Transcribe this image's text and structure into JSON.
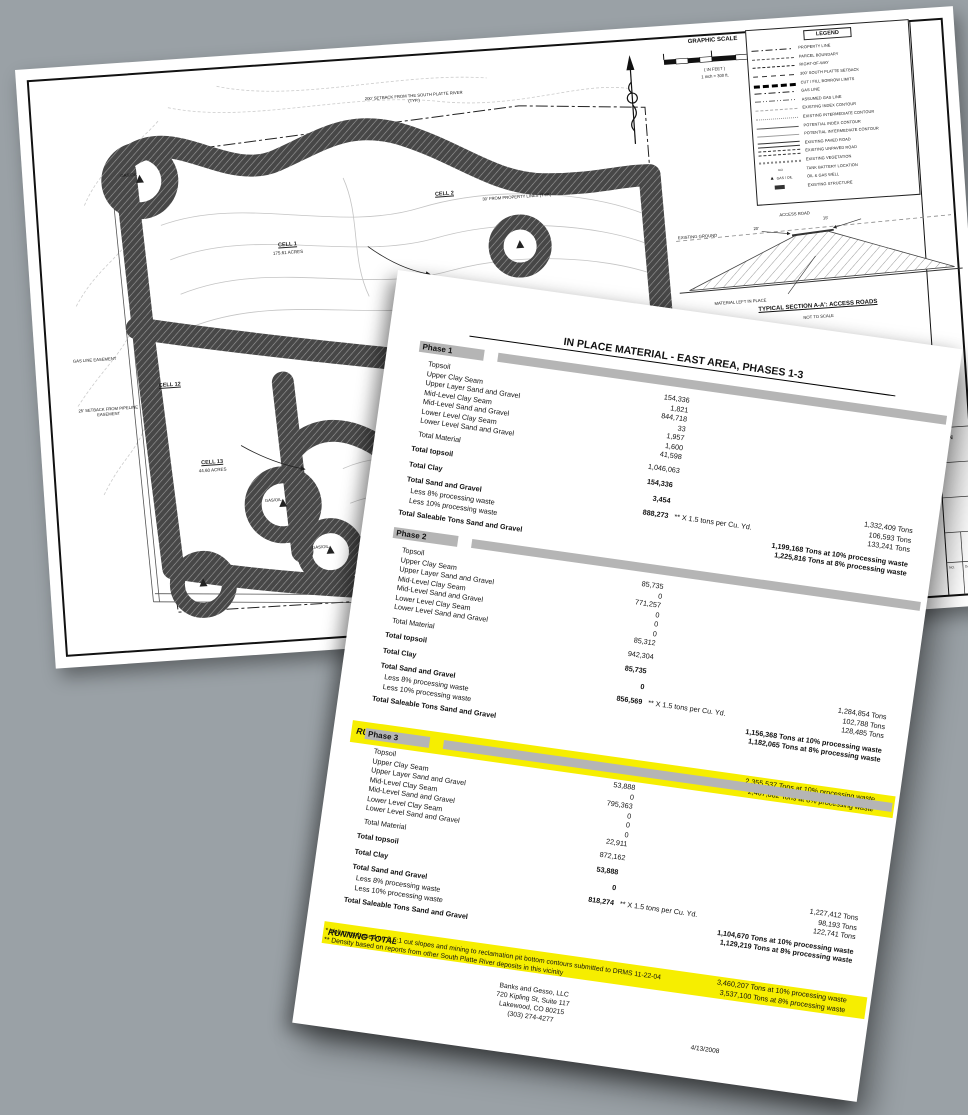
{
  "page": {
    "background": "#9aa1a6"
  },
  "colors": {
    "highlight_yellow": "#f6ee00",
    "band_gray": "#b5b5b5"
  },
  "map_sheet": {
    "graphic_scale": {
      "title": "GRAPHIC SCALE",
      "in_feet": "( IN FEET )",
      "scale_note": "1 inch = 300 ft."
    },
    "legend": {
      "title": "LEGEND",
      "well_symbol_label": "GAS / OIL",
      "items": [
        "PROPERTY LINE",
        "PARCEL BOUNDARY",
        "RIGHT-OF-WAY",
        "300' SOUTH PLATTE SETBACK",
        "CUT / FILL BORROW LIMITS",
        "GAS LINE",
        "ASSUMED GAS LINE",
        "EXISTING INDEX CONTOUR",
        "EXISTING INTERMEDIATE CONTOUR",
        "POTENTIAL INDEX CONTOUR",
        "POTENTIAL INTERMEDIATE CONTOUR",
        "EXISTING PAVED ROAD",
        "EXISTING UNPAVED ROAD",
        "EXISTING VEGETATION",
        "TANK BATTERY LOCATION",
        "OIL & GAS WELL",
        "EXISTING STRUCTURE"
      ]
    },
    "cells": [
      {
        "name": "CELL 1",
        "acres": "175.61 ACRES"
      },
      {
        "name": "CELL 2",
        "acres": ""
      },
      {
        "name": "CELL 11",
        "acres": "93.90 ACRES"
      },
      {
        "name": "CELL 12",
        "acres": ""
      },
      {
        "name": "CELL 13",
        "acres": "44.60 ACRES"
      }
    ],
    "annotations": {
      "river_setback": "200' SETBACK FROM THE SOUTH PLATTE RIVER (TYP.)",
      "property_setback": "30' FROM PROPERTY LINES (TYP.)",
      "gas_line_easement": "GAS LINE EASEMENT",
      "pipeline_setback": "25' SETBACK FROM PIPELINE EASEMENT",
      "well_label": "GAS/OIL"
    },
    "section": {
      "title": "TYPICAL SECTION A-A': ACCESS ROADS",
      "subtitle": "NOT TO SCALE",
      "existing_ground": "EXISTING GROUND",
      "access_road": "ACCESS ROAD",
      "material_note": "MATERIAL LEFT IN PLACE",
      "dim_left": "20'",
      "dim_right": "15'"
    },
    "title_block": {
      "fragment": "AN",
      "rev_label": "NO.",
      "date_label": "DATE"
    }
  },
  "report": {
    "title": "IN PLACE MATERIAL - EAST AREA, PHASES 1-3",
    "seam_labels": [
      "Topsoil",
      "Upper Clay Seam",
      "Upper Layer Sand and Gravel",
      "Mid-Level Clay Seam",
      "Mid-Level Sand and Gravel",
      "Lower Level Clay Seam",
      "Lower Level Sand and Gravel"
    ],
    "labels": {
      "total_material": "Total Material",
      "total_topsoil": "Total topsoil",
      "total_clay": "Total Clay",
      "total_sand": "Total Sand and Gravel",
      "less8": "Less 8% processing waste",
      "less10": "Less 10% processing waste",
      "saleable": "Total Saleable Tons Sand and Gravel",
      "running": "RUNNING TOTAL"
    },
    "note": "** X 1.5 tons per Cu. Yd.",
    "phases": [
      {
        "name": "Phase 1",
        "seam_values": [
          "154,336",
          "1,821",
          "844,718",
          "33",
          "1,957",
          "1,600",
          "41,598"
        ],
        "total_material": "1,046,063",
        "total_topsoil": "154,336",
        "total_clay": "3,454",
        "total_sand": "888,273",
        "tons": [
          "1,332,409  Tons",
          "106,593  Tons",
          "133,241  Tons"
        ],
        "net10": "1,199,168  Tons at 10% processing waste",
        "net8": "1,225,816  Tons at 8% processing waste"
      },
      {
        "name": "Phase 2",
        "seam_values": [
          "85,735",
          "0",
          "771,257",
          "0",
          "0",
          "0",
          "85,312"
        ],
        "total_material": "942,304",
        "total_topsoil": "85,735",
        "total_clay": "0",
        "total_sand": "856,569",
        "tons": [
          "1,284,854  Tons",
          "102,788  Tons",
          "128,485  Tons"
        ],
        "net10": "1,156,368  Tons at 10% processing waste",
        "net8": "1,182,065  Tons at 8% processing waste",
        "running10": "2,355,537  Tons at 10% processing waste",
        "running8": "2,407,882  Tons at 8% processing waste"
      },
      {
        "name": "Phase 3",
        "seam_values": [
          "53,888",
          "0",
          "795,363",
          "0",
          "0",
          "0",
          "22,911"
        ],
        "total_material": "872,162",
        "total_topsoil": "53,888",
        "total_clay": "0",
        "total_sand": "818,274",
        "tons": [
          "1,227,412  Tons",
          "98,193  Tons",
          "122,741  Tons"
        ],
        "net10": "1,104,670  Tons at 10% processing waste",
        "net8": "1,129,219  Tons at 8% processing waste",
        "running10": "3,460,207  Tons at 10% processing waste",
        "running8": "3,537,100  Tons at 8% processing waste"
      }
    ],
    "footnotes": [
      "* Volumes based on 0.5:1 cut slopes and mining to reclamation pit bottom contours submitted to DRMS 11-22-04",
      "** Density based on reports from other South Platte River deposits in this vicinity"
    ],
    "company": [
      "Banks and Gesso, LLC",
      "720 Kipling St, Suite 117",
      "Lakewood, CO 80215",
      "(303) 274-4277"
    ],
    "date": "4/13/2008"
  }
}
